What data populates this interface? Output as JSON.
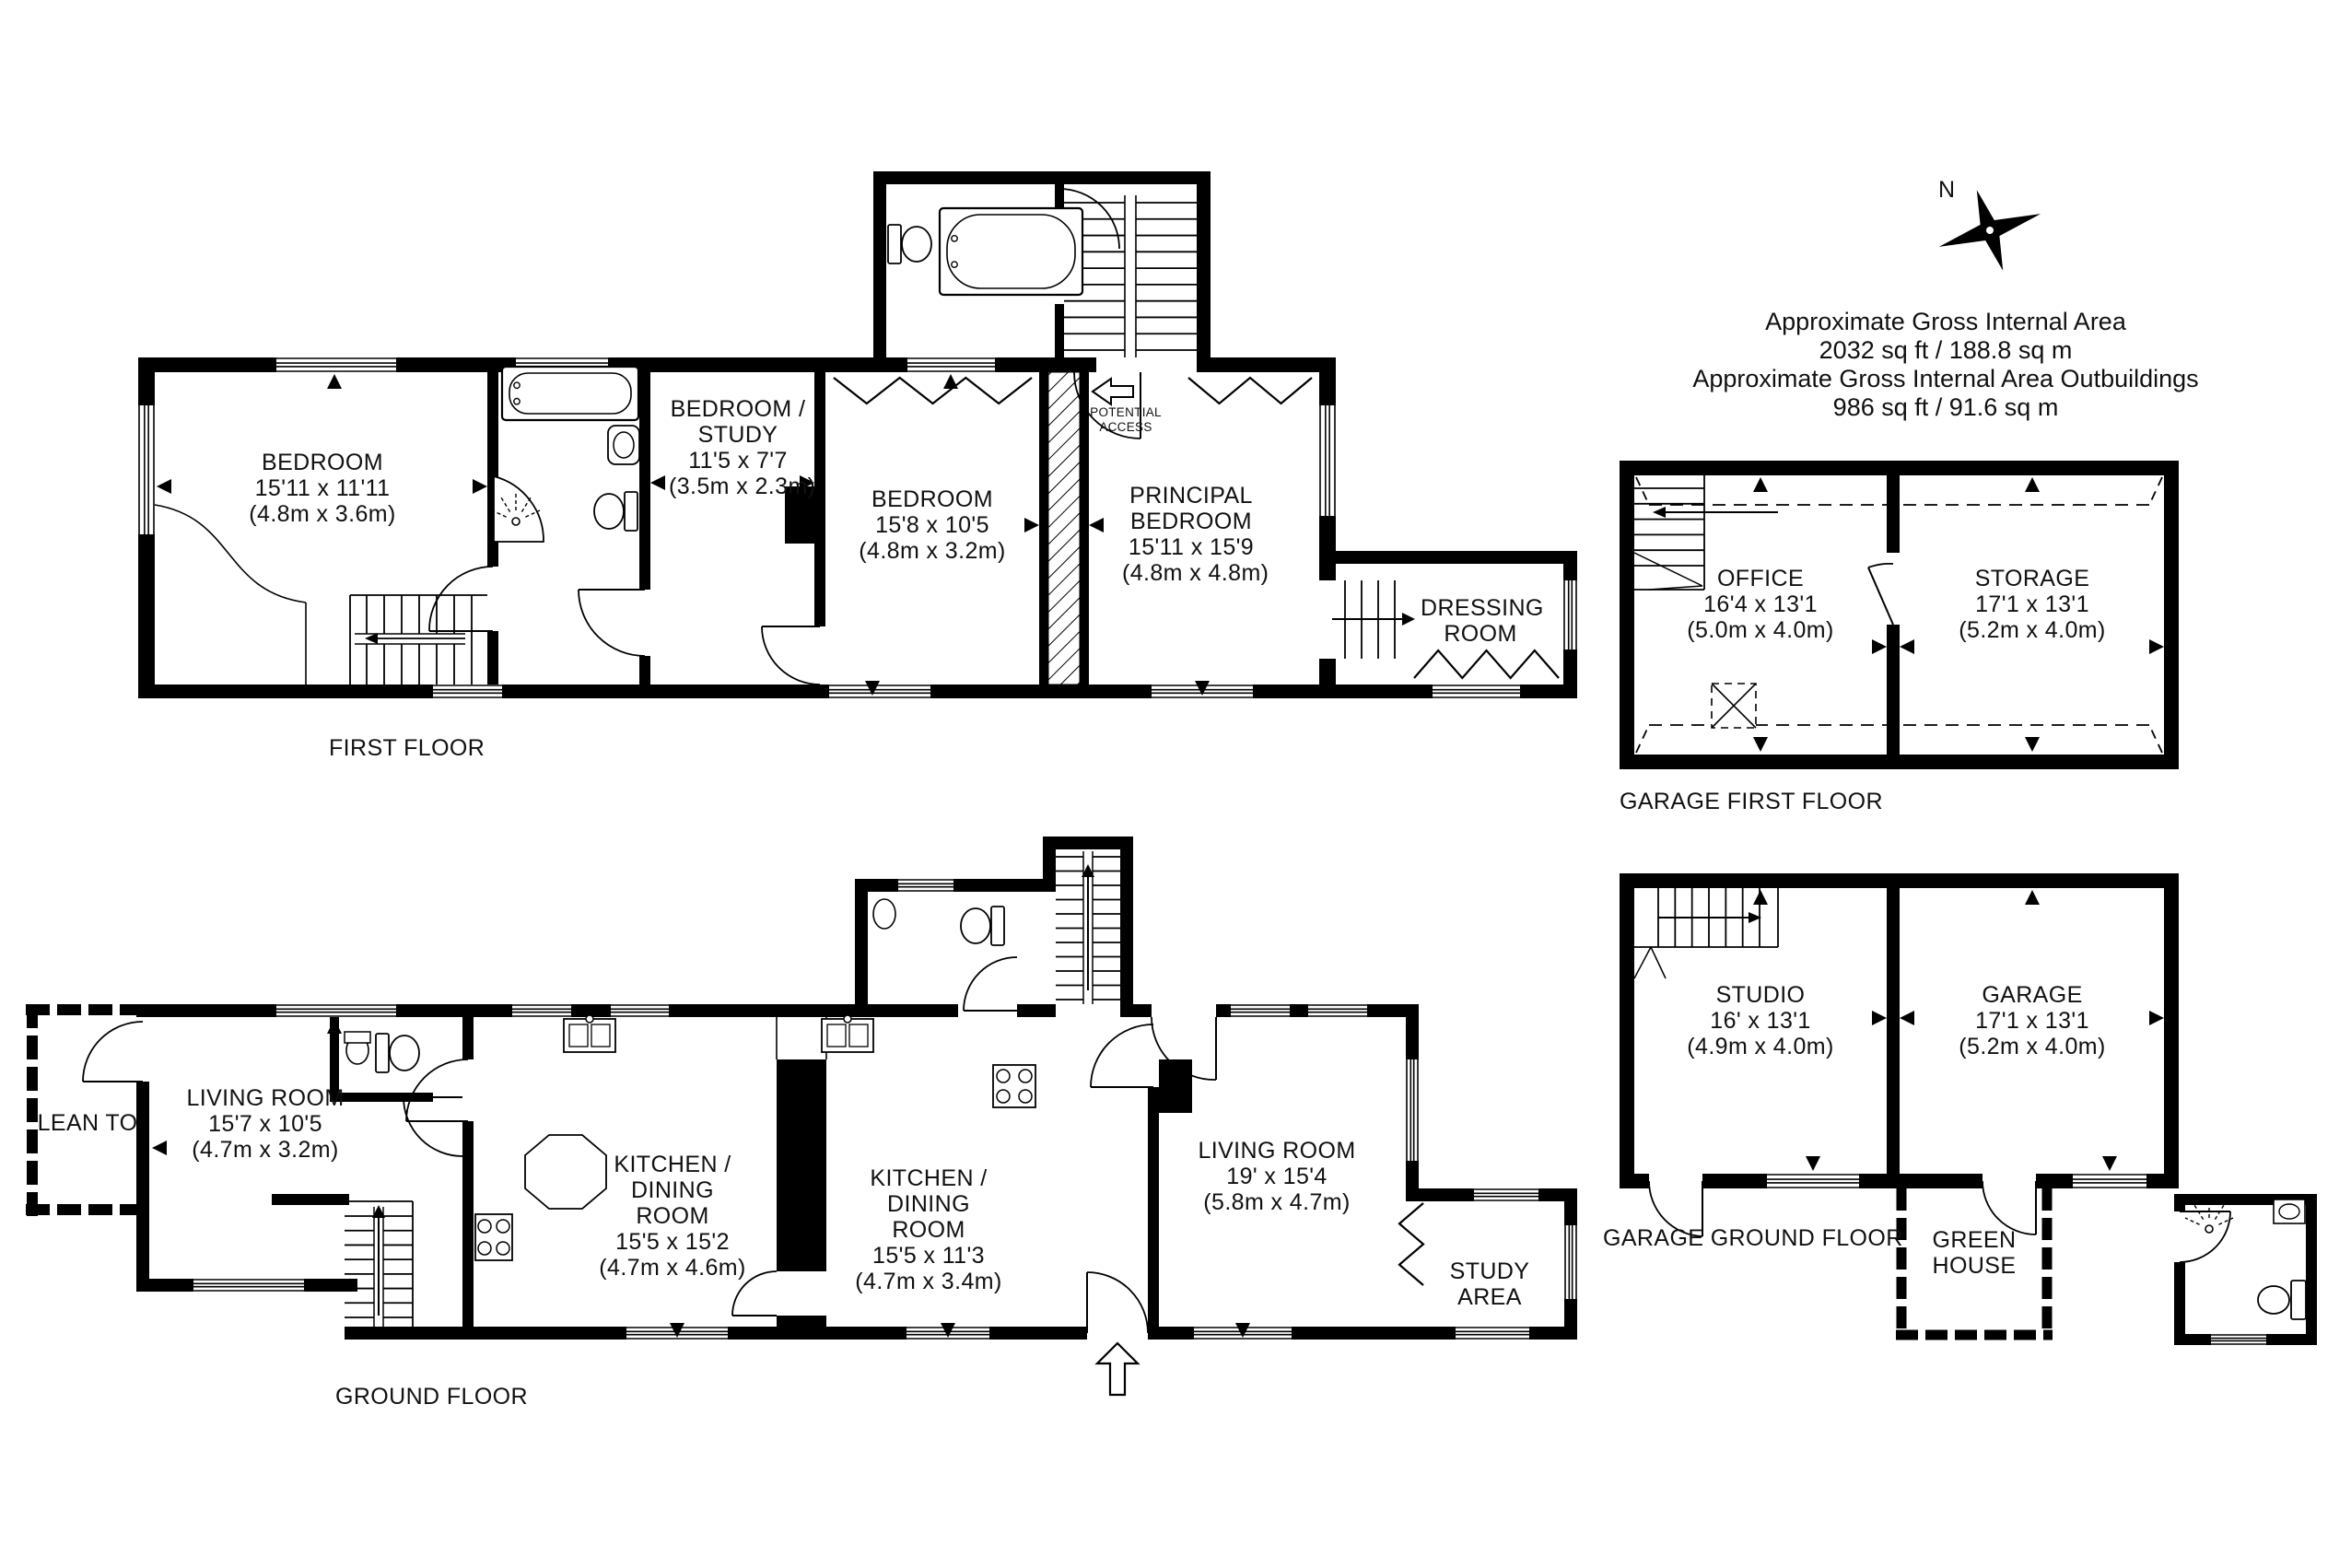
{
  "compass": {
    "north_label": "N"
  },
  "area_summary": {
    "line1": "Approximate Gross Internal Area",
    "line2": "2032 sq ft / 188.8 sq m",
    "line3": "Approximate Gross Internal Area Outbuildings",
    "line4": "986 sq ft / 91.6 sq m"
  },
  "floors": {
    "first_floor": {
      "label": "FIRST FLOOR",
      "note": "POTENTIAL ACCESS",
      "rooms": [
        {
          "name": "BEDROOM",
          "dims_ft": "15'11 x 11'11",
          "dims_m": "(4.8m x 3.6m)"
        },
        {
          "name": "BEDROOM / STUDY",
          "dims_ft": "11'5 x 7'7",
          "dims_m": "(3.5m x 2.3m)"
        },
        {
          "name": "BEDROOM",
          "dims_ft": "15'8 x 10'5",
          "dims_m": "(4.8m x 3.2m)"
        },
        {
          "name": "PRINCIPAL BEDROOM",
          "dims_ft": "15'11 x 15'9",
          "dims_m": "(4.8m x 4.8m)"
        },
        {
          "name": "DRESSING ROOM"
        }
      ]
    },
    "ground_floor": {
      "label": "GROUND FLOOR",
      "rooms": [
        {
          "name": "LEAN TO"
        },
        {
          "name": "LIVING ROOM",
          "dims_ft": "15'7 x 10'5",
          "dims_m": "(4.7m x 3.2m)"
        },
        {
          "name": "KITCHEN / DINING ROOM",
          "dims_ft": "15'5 x 15'2",
          "dims_m": "(4.7m x 4.6m)"
        },
        {
          "name": "KITCHEN / DINING ROOM",
          "dims_ft": "15'5 x 11'3",
          "dims_m": "(4.7m x 3.4m)"
        },
        {
          "name": "LIVING ROOM",
          "dims_ft": "19' x 15'4",
          "dims_m": "(5.8m x 4.7m)"
        },
        {
          "name": "STUDY AREA"
        }
      ]
    },
    "garage_first_floor": {
      "label": "GARAGE FIRST FLOOR",
      "rooms": [
        {
          "name": "OFFICE",
          "dims_ft": "16'4 x 13'1",
          "dims_m": "(5.0m x 4.0m)"
        },
        {
          "name": "STORAGE",
          "dims_ft": "17'1 x 13'1",
          "dims_m": "(5.2m x 4.0m)"
        }
      ]
    },
    "garage_ground_floor": {
      "label": "GARAGE GROUND FLOOR",
      "rooms": [
        {
          "name": "STUDIO",
          "dims_ft": "16' x 13'1",
          "dims_m": "(4.9m x 4.0m)"
        },
        {
          "name": "GARAGE",
          "dims_ft": "17'1 x 13'1",
          "dims_m": "(5.2m x 4.0m)"
        },
        {
          "name": "GREEN HOUSE"
        }
      ]
    }
  }
}
